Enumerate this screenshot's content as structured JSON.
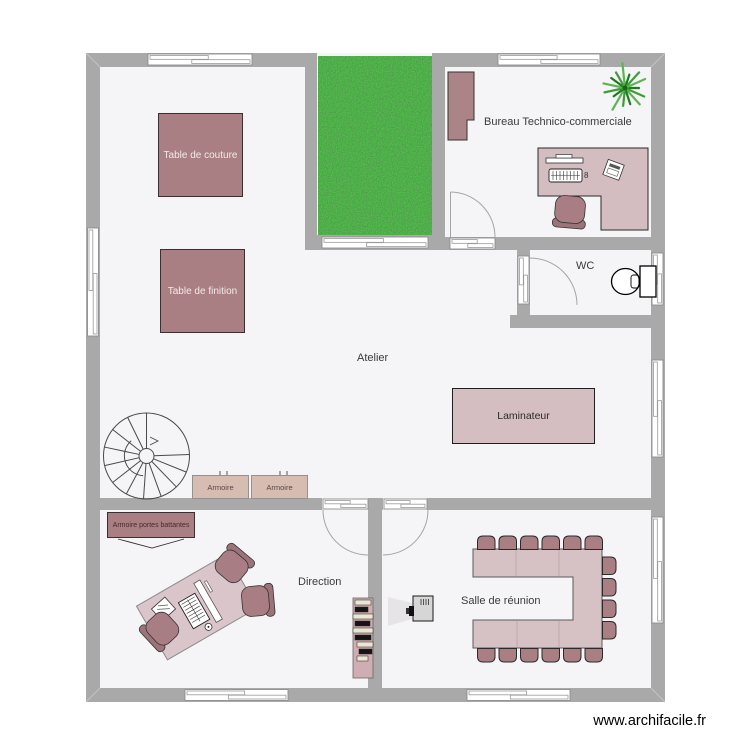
{
  "watermark": "www.archifacile.fr",
  "rooms": {
    "atelier": "Atelier",
    "bureau": "Bureau Technico-commerciale",
    "wc": "WC",
    "direction": "Direction",
    "salle_reunion": "Salle de réunion"
  },
  "furniture": {
    "table_couture": "Table de couture",
    "table_finition": "Table de finition",
    "laminateur": "Laminateur",
    "armoire_1": "Armoire",
    "armoire_2": "Armoire",
    "armoire_portes_battantes": "Armoire portes battantes",
    "desk_count_badge": "8"
  },
  "icons": [
    "spiral-staircase-icon",
    "toilet-icon",
    "plant-icon",
    "projector-icon",
    "bookshelf-icon",
    "office-chair-icon",
    "window-icon",
    "door-arc-icon"
  ],
  "colors": {
    "wall": "#a9a9a9",
    "floor": "#f5f4f6",
    "grass": "#3c8c3a",
    "furniture_mauve": "#a97f83",
    "furniture_pink": "#d5bec2",
    "armoire_tan": "#d7bdb1",
    "chair": "#a87e84"
  }
}
